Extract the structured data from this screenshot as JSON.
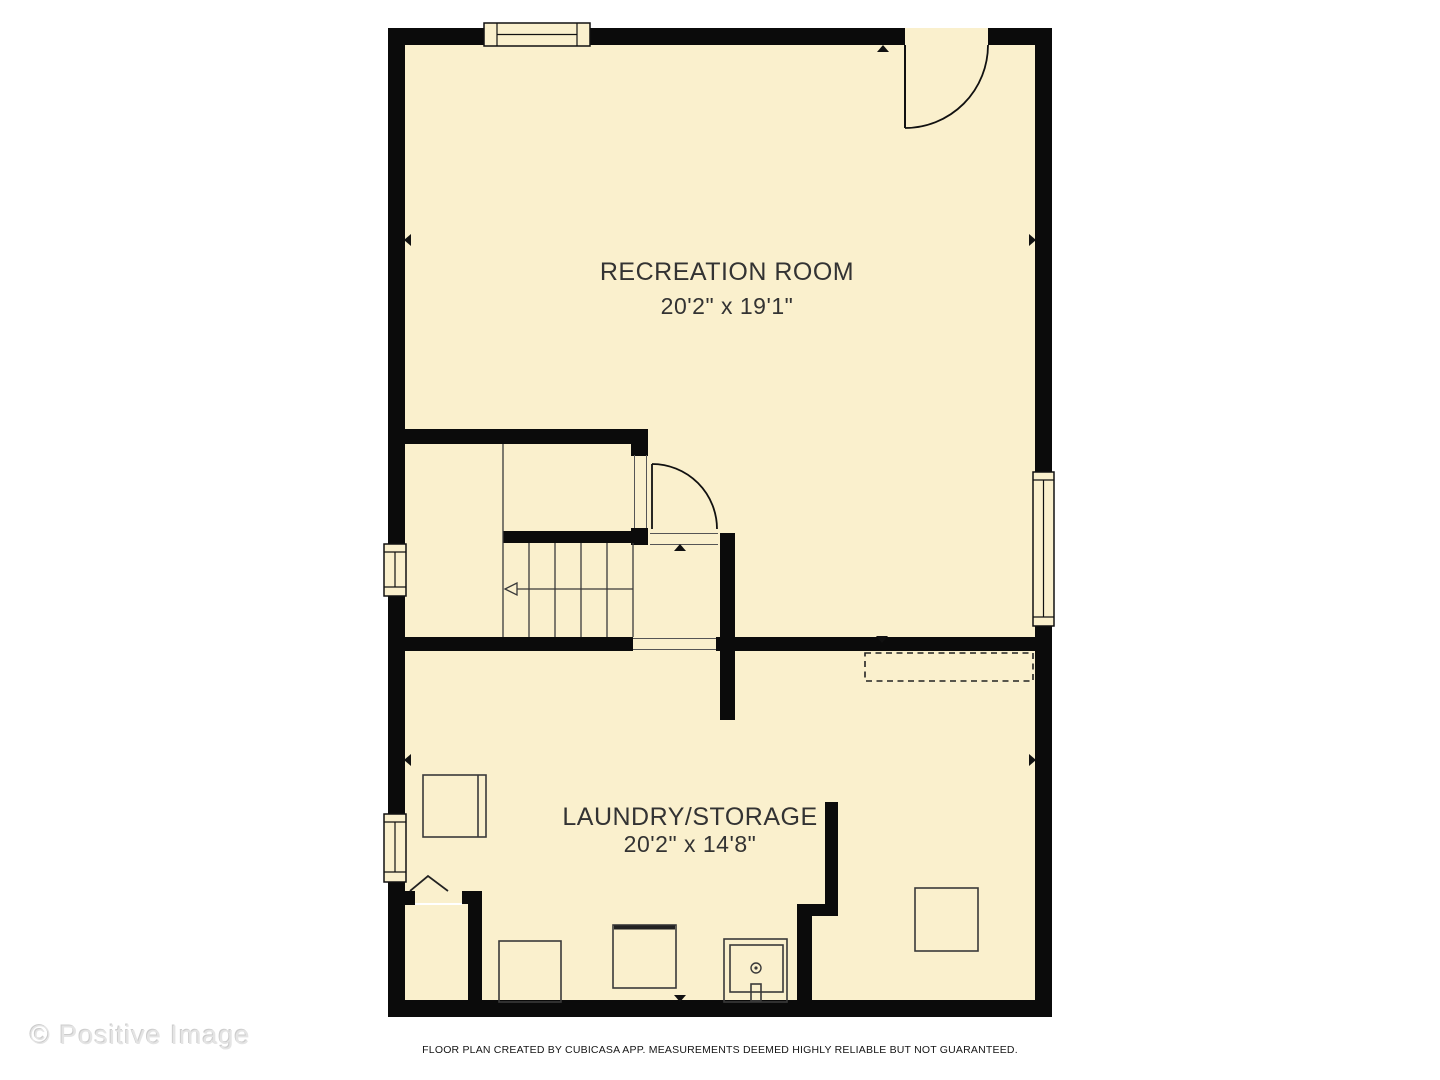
{
  "rooms": [
    {
      "name": "RECREATION ROOM",
      "dimensions": "20'2\" x 19'1\""
    },
    {
      "name": "LAUNDRY/STORAGE",
      "dimensions": "20'2\" x 14'8\""
    }
  ],
  "watermark": "© Positive Image",
  "footer": "FLOOR PLAN CREATED BY CUBICASA APP. MEASUREMENTS DEEMED HIGHLY RELIABLE BUT NOT GUARANTEED.",
  "colors": {
    "floor": "#FAF0CD",
    "wall": "#0B0B0B",
    "line": "#3A3A3A",
    "label": "#333333",
    "watermark": "#E4E4E4"
  }
}
